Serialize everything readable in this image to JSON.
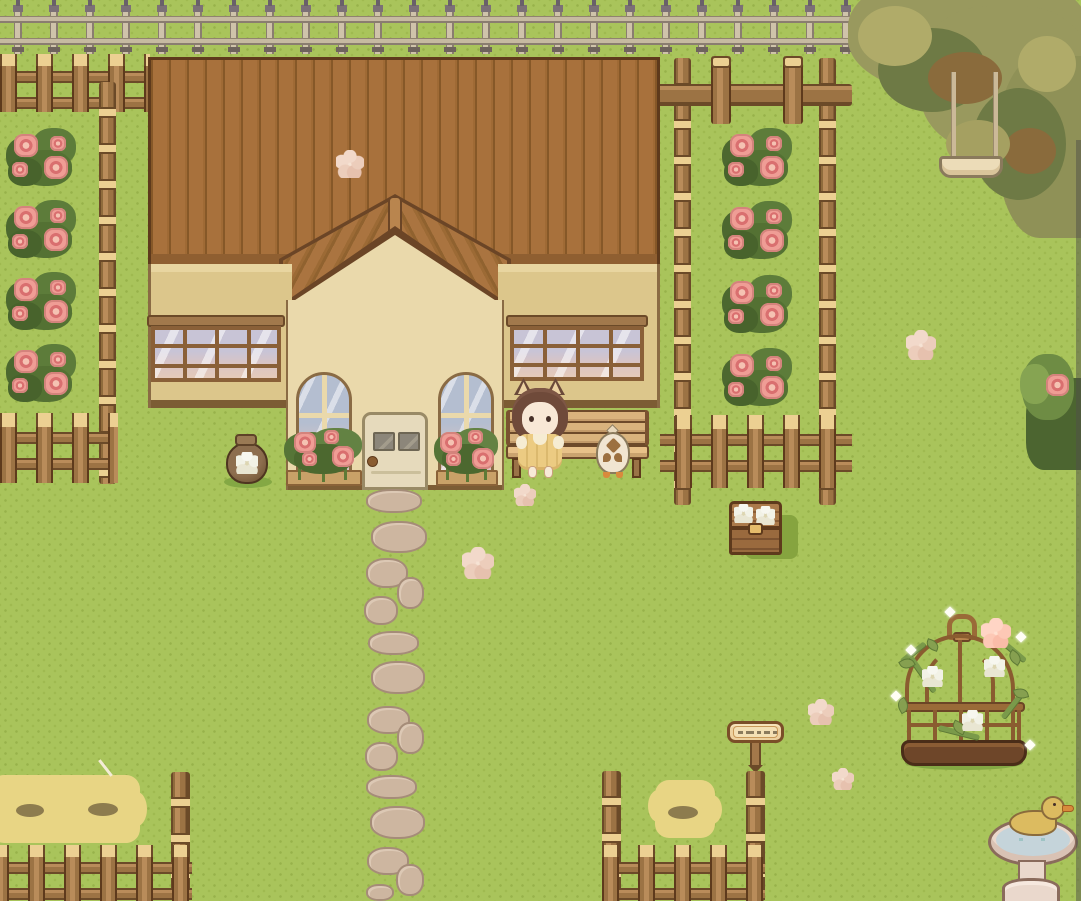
{
  "scene": {
    "label": "Cozy top-down pixel-art cottage garden: girl and chicken sitting on a bench in front of a cream cottage with brown plank roof, rose gardens, wooden fences, swing tree, flower birdcage and duck bird-bath",
    "width_px": 1081,
    "height_px": 901
  },
  "palette": {
    "grass": "#a9c45b",
    "grass_dot": "#97b24a",
    "roof": "#a8713c",
    "roof_line": "#8a5c30",
    "roof_outline": "#5e3a1c",
    "wall_cream": "#ead9ab",
    "wall_tan": "#dcc68b",
    "baseboard": "#7c5c34",
    "wood": "#9c7344",
    "wood_light": "#b98c5a",
    "wood_cap": "#ecd092",
    "wood_dark": "#6b4a28",
    "iron_fence": "#c6baa1",
    "iron_finial": "#69606a",
    "leaf_dark": "#4c6530",
    "leaf_mid": "#6e8c44",
    "leaf_light": "#86a452",
    "rose_pink": "#ef9d95",
    "rose_deep": "#d96f6f",
    "stone": "#cdb6a0",
    "hay": "#e8d584",
    "girl_hair": "#6f4a3a",
    "girl_dress": "#eccb82",
    "girl_skin": "#f8e8d6",
    "chicken_body": "#f1e5d1",
    "chicken_marking": "#9c7040",
    "water": "#c5d4da",
    "duck": "#dcbb60",
    "bath_stone": "#ead8cc",
    "tree_olive": "#99995e",
    "tree_dark": "#6e7a45",
    "tree_branch": "#8a6b3c",
    "blossom": "#eed4c5"
  },
  "entities": {
    "cottage": {
      "label": "cottage with brown plank roof and cream gable"
    },
    "roof": {
      "label": "brown plank roof"
    },
    "gable": {
      "label": "front gable with diagonal plank eaves"
    },
    "door": {
      "label": "cream front door with two small panes and round knob"
    },
    "window_left": {
      "label": "left wing lattice window"
    },
    "window_right": {
      "label": "right wing lattice window"
    },
    "arch_window_left": {
      "label": "left arched window"
    },
    "arch_window_right": {
      "label": "right arched window"
    },
    "planter_left": {
      "label": "rose planter under left arched window"
    },
    "planter_right": {
      "label": "rose planter under right arched window"
    },
    "bench": {
      "label": "wooden bench"
    },
    "girl": {
      "label": "girl with animal ears in yellow dress sitting on bench"
    },
    "chicken": {
      "label": "cream chicken standing on bench"
    },
    "pot": {
      "label": "brown jar painted with white flower"
    },
    "chest": {
      "label": "wooden storage chest decorated with two white flowers"
    },
    "sign": {
      "label": "wooden signpost with engraved marks"
    },
    "path": {
      "label": "stepping stone path"
    },
    "garden_left": {
      "label": "left rose garden with log fence"
    },
    "garden_right": {
      "label": "right rose garden corridor with log fences"
    },
    "iron_fence": {
      "label": "iron fence along the top"
    },
    "tree": {
      "label": "large tree overhanging top-right corner"
    },
    "swing": {
      "label": "rope swing hanging from tree"
    },
    "birdcage": {
      "label": "decorative birdcage overgrown with vines and white flowers"
    },
    "birdbath": {
      "label": "stone bird bath"
    },
    "duck": {
      "label": "yellow duck bathing in bird bath"
    },
    "hay_left": {
      "label": "hay feeding patch in left pen"
    },
    "hay_right": {
      "label": "hay patch in right pen"
    },
    "pen_left": {
      "label": "left animal pen fence"
    },
    "pen_right": {
      "label": "right animal pen fence"
    },
    "corner_bush": {
      "label": "dark bush with pink rose at right edge"
    }
  },
  "sign_marks": [
    5,
    9,
    5,
    7,
    4
  ],
  "rose_bushes": [
    {
      "x": 6,
      "y": 128
    },
    {
      "x": 6,
      "y": 200
    },
    {
      "x": 6,
      "y": 272
    },
    {
      "x": 6,
      "y": 344
    },
    {
      "x": 722,
      "y": 128
    },
    {
      "x": 722,
      "y": 201
    },
    {
      "x": 722,
      "y": 275
    },
    {
      "x": 722,
      "y": 348
    }
  ],
  "path_stones": [
    [
      366,
      489,
      56,
      24
    ],
    [
      371,
      521,
      56,
      32
    ],
    [
      366,
      558,
      42,
      30
    ],
    [
      397,
      577,
      27,
      32
    ],
    [
      364,
      596,
      34,
      29
    ],
    [
      368,
      631,
      51,
      24
    ],
    [
      371,
      661,
      54,
      33
    ],
    [
      367,
      706,
      43,
      28
    ],
    [
      397,
      722,
      27,
      32
    ],
    [
      365,
      742,
      33,
      29
    ],
    [
      366,
      775,
      51,
      24
    ],
    [
      370,
      806,
      55,
      33
    ],
    [
      367,
      847,
      42,
      28
    ],
    [
      396,
      864,
      28,
      32
    ],
    [
      366,
      884,
      28,
      17
    ]
  ],
  "blossoms": [
    [
      336,
      150,
      28
    ],
    [
      906,
      330,
      30
    ],
    [
      514,
      484,
      22
    ],
    [
      462,
      547,
      32
    ],
    [
      808,
      699,
      26
    ],
    [
      832,
      768,
      22
    ],
    [
      981,
      618,
      30
    ]
  ],
  "sparkles": [
    [
      907,
      646
    ],
    [
      1017,
      633
    ],
    [
      892,
      692
    ],
    [
      1026,
      741
    ],
    [
      946,
      608
    ]
  ],
  "hay_spots": [
    [
      16,
      804,
      28,
      13
    ],
    [
      88,
      803,
      30,
      13
    ],
    [
      668,
      806,
      30,
      13
    ]
  ]
}
